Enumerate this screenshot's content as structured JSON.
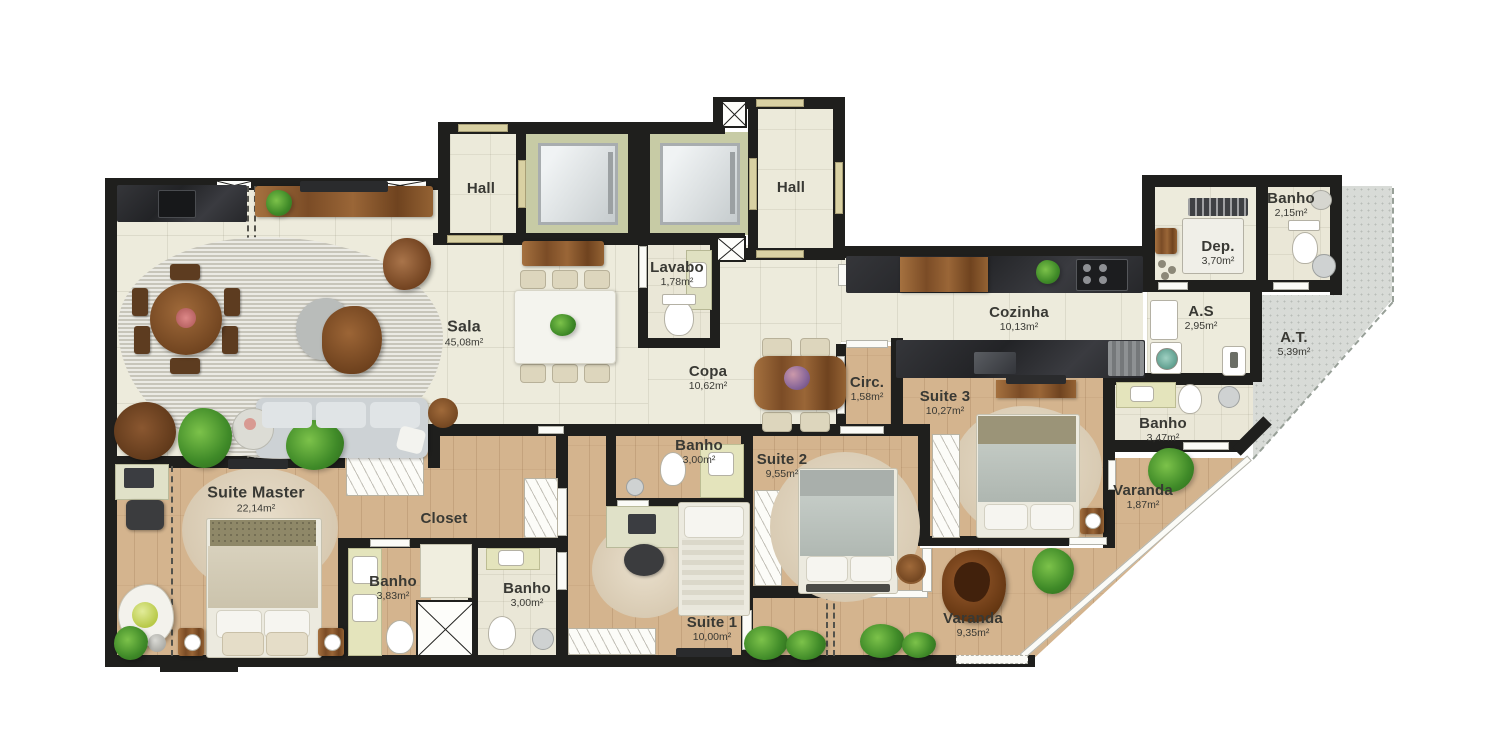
{
  "rooms": [
    {
      "id": "hall-esquerdo",
      "name": "Hall",
      "area": ""
    },
    {
      "id": "hall-direito",
      "name": "Hall",
      "area": ""
    },
    {
      "id": "lavabo",
      "name": "Lavabo",
      "area": "1,78m²"
    },
    {
      "id": "sala",
      "name": "Sala",
      "area": "45,08m²"
    },
    {
      "id": "copa",
      "name": "Copa",
      "area": "10,62m²"
    },
    {
      "id": "cozinha",
      "name": "Cozinha",
      "area": "10,13m²"
    },
    {
      "id": "dep",
      "name": "Dep.",
      "area": "3,70m²"
    },
    {
      "id": "banho-servico",
      "name": "Banho",
      "area": "2,15m²"
    },
    {
      "id": "area-servico",
      "name": "A.S",
      "area": "2,95m²"
    },
    {
      "id": "area-tecnica",
      "name": "A.T.",
      "area": "5,39m²"
    },
    {
      "id": "circulacao",
      "name": "Circ.",
      "area": "1,58m²"
    },
    {
      "id": "suite-3",
      "name": "Suite 3",
      "area": "10,27m²"
    },
    {
      "id": "banho-suite-3",
      "name": "Banho",
      "area": "3,47m²"
    },
    {
      "id": "varanda-suite-3",
      "name": "Varanda",
      "area": "1,87m²"
    },
    {
      "id": "suite-2",
      "name": "Suite 2",
      "area": "9,55m²"
    },
    {
      "id": "banho-social",
      "name": "Banho",
      "area": "3,00m²"
    },
    {
      "id": "suite-master",
      "name": "Suite Master",
      "area": "22,14m²"
    },
    {
      "id": "closet",
      "name": "Closet",
      "area": ""
    },
    {
      "id": "banho-master",
      "name": "Banho",
      "area": "3,83m²"
    },
    {
      "id": "banho-suite-1",
      "name": "Banho",
      "area": "3,00m²"
    },
    {
      "id": "suite-1",
      "name": "Suite 1",
      "area": "10,00m²"
    },
    {
      "id": "varanda",
      "name": "Varanda",
      "area": "9,35m²"
    }
  ]
}
